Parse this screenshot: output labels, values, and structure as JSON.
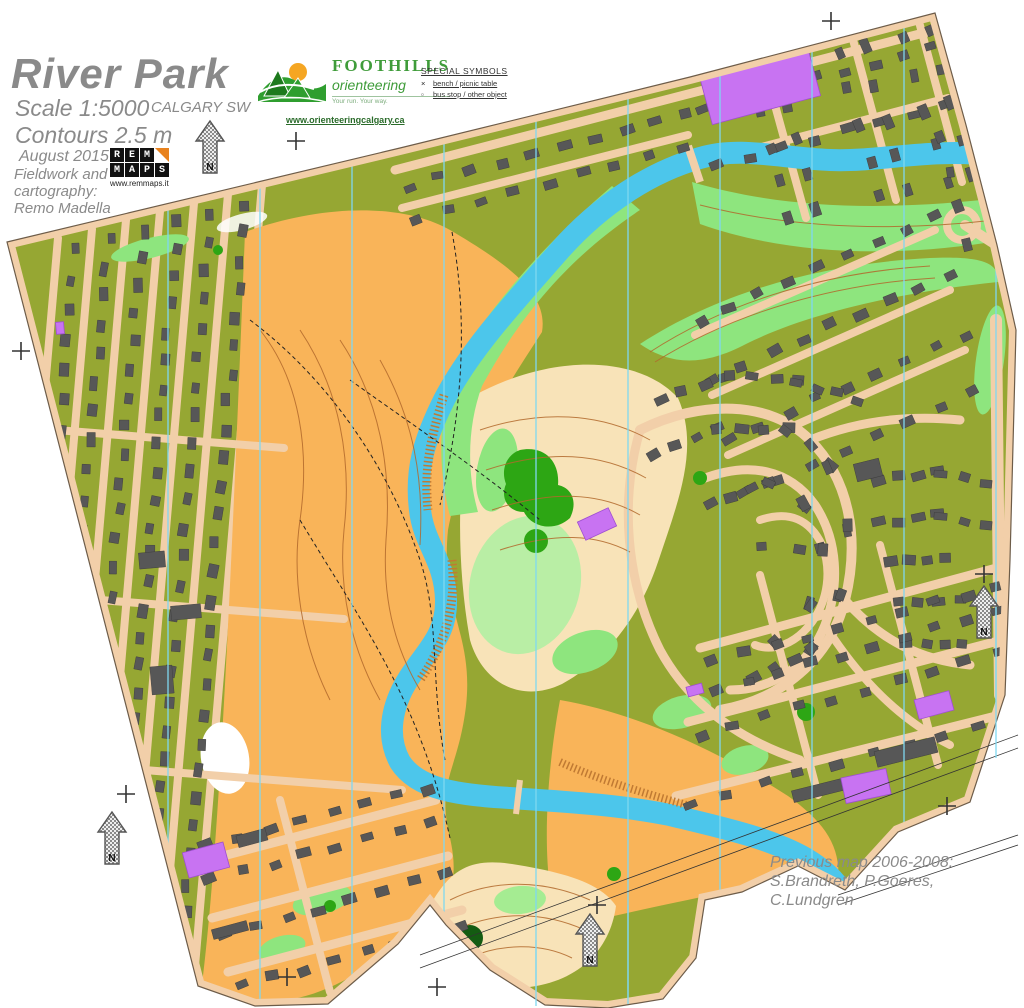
{
  "header": {
    "title": "River Park",
    "region": "CALGARY SW",
    "scale": "Scale 1:5000",
    "contours": "Contours 2.5 m",
    "date": "August 2015",
    "credit_lines": [
      "Fieldwork and",
      "cartography:",
      "Remo Madella"
    ]
  },
  "rem_maps": {
    "rows": [
      [
        "R",
        "E",
        "M"
      ],
      [
        "M",
        "A",
        "P",
        "S"
      ]
    ],
    "url": "www.remmaps.it"
  },
  "foothills": {
    "name": "FOOTHILLS",
    "sub": "orienteering",
    "tagline": "Your run. Your way.",
    "url": "www.orienteeringcalgary.ca"
  },
  "special_symbols": {
    "heading": "SPECIAL SYMBOLS",
    "items": [
      {
        "symbol": "×",
        "label": "bench / picnic table"
      },
      {
        "symbol": "▫",
        "label": "bus stop / other object"
      }
    ]
  },
  "previous_map": {
    "lines": [
      "Previous map 2006-2008:",
      "S.Brandreth, P.Goeres,",
      "C.Lundgren"
    ]
  },
  "north_arrow_label": "N",
  "colors": {
    "map_tan": "#f2cfa9",
    "olive_green": "#96a733",
    "orange_open": "#f9b459",
    "pale_cream": "#f8e3b8",
    "light_green": "#8ee57e",
    "bright_green": "#2da614",
    "dark_green": "#145c12",
    "river_blue": "#4cc6eb",
    "building_gray": "#575757",
    "forbidden_purple": "#c873f2",
    "meridian_blue": "#7fd8f0",
    "contour_brown": "#b2692c",
    "title_gray": "#8a8a8a"
  }
}
